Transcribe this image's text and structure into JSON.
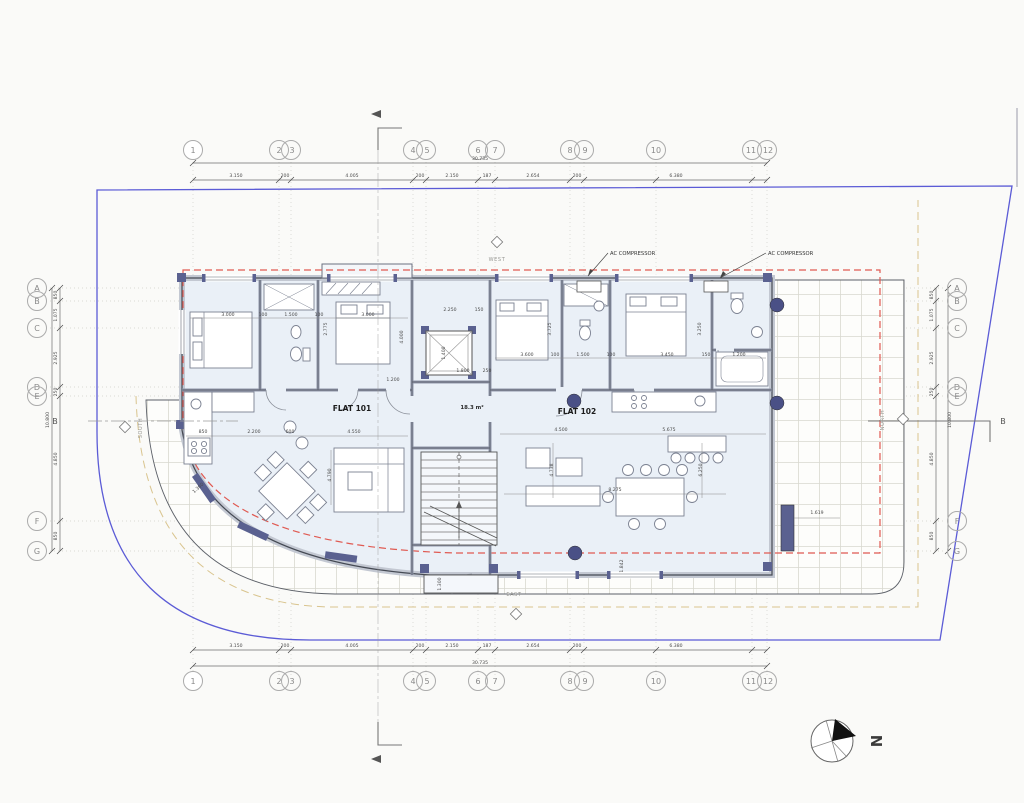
{
  "grid": {
    "top": [
      "1",
      "2",
      "3",
      "4",
      "5",
      "6",
      "7",
      "8",
      "9",
      "10",
      "11",
      "12"
    ],
    "left": [
      "A",
      "B",
      "C",
      "D",
      "E",
      "F",
      "G"
    ]
  },
  "flats": {
    "flat101": "FLAT 101",
    "flat102": "FLAT 102",
    "landing_area": "18.3 m²"
  },
  "annotations": {
    "ac_compressor_1": "AC COMPRESSOR",
    "ac_compressor_2": "AC COMPRESSOR",
    "west": "WEST",
    "east": "EAST",
    "north": "NORTH",
    "south": "SOUTH",
    "section_b_left": "B",
    "section_b_right": "B",
    "north_arrow_letter": "N"
  },
  "dims": {
    "top_total": "30.735",
    "top": [
      "3.150",
      "200",
      "4.005",
      "200",
      "2.150",
      "187",
      "2.654",
      "200",
      "6.380"
    ],
    "side": [
      "850",
      "1.075",
      "2.925",
      "250",
      "4.850",
      "850"
    ],
    "side_total": "10.800",
    "interior": [
      "3.000",
      "100",
      "1.500",
      "100",
      "3.000",
      "2.250",
      "150",
      "3.600",
      "100",
      "1.500",
      "100",
      "3.450",
      "150",
      "1.200",
      "4.000",
      "3.725",
      "3.250",
      "1.400",
      "1.800",
      "250",
      "2.200",
      "600",
      "4.550",
      "4.500",
      "5.675",
      "4.790",
      "4.738",
      "6.250",
      "8.275",
      "1.360",
      "1.842",
      "1.619",
      "1.200",
      "1.300",
      "850",
      "2.775"
    ]
  },
  "colors": {
    "boundary_blue": "#5b5bd6",
    "setback_red": "#e05a52",
    "easement_tan": "#d9c48e",
    "wall_slate": "#5a6190",
    "room_fill": "#eaf0f7"
  }
}
